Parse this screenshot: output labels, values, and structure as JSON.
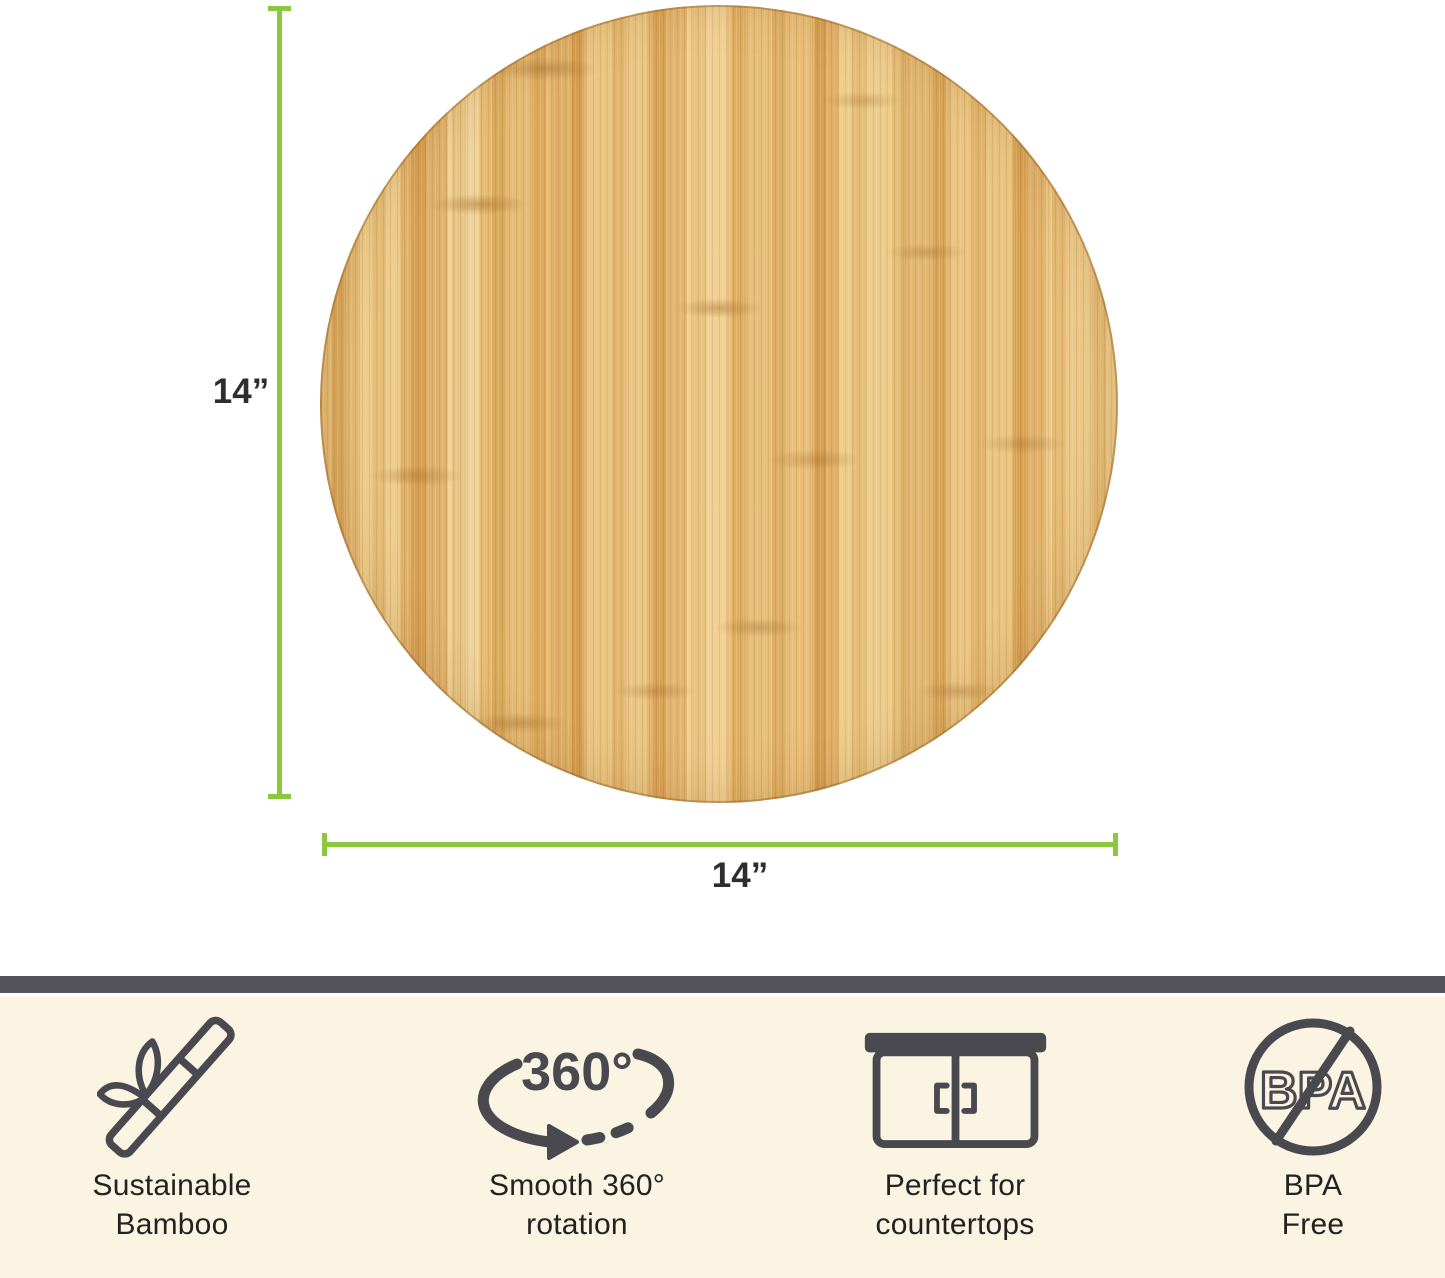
{
  "dimension_annotation": {
    "height_label": "14”",
    "width_label": "14”"
  },
  "features": [
    {
      "id": "sustainable-bamboo",
      "icon": "bamboo-icon",
      "line1": "Sustainable",
      "line2": "Bamboo"
    },
    {
      "id": "smooth-rotation",
      "icon": "rotation-360-icon",
      "icon_text": "360°",
      "line1": "Smooth 360°",
      "line2": "rotation"
    },
    {
      "id": "countertops",
      "icon": "countertop-cabinet-icon",
      "line1": "Perfect for",
      "line2": "countertops"
    },
    {
      "id": "bpa-free",
      "icon": "bpa-free-icon",
      "icon_text": "BPA",
      "line1": "BPA",
      "line2": "Free"
    }
  ],
  "colors": {
    "background": "#ffffff",
    "dimension_line": "#8dc63f",
    "dimension_label_text": "#2e2e2e",
    "banner_bar": "#55535c",
    "banner_background": "#fbf4e2",
    "icon_stroke": "#4a4950",
    "feature_label_text": "#222222",
    "wood_base": "#e2b166"
  }
}
